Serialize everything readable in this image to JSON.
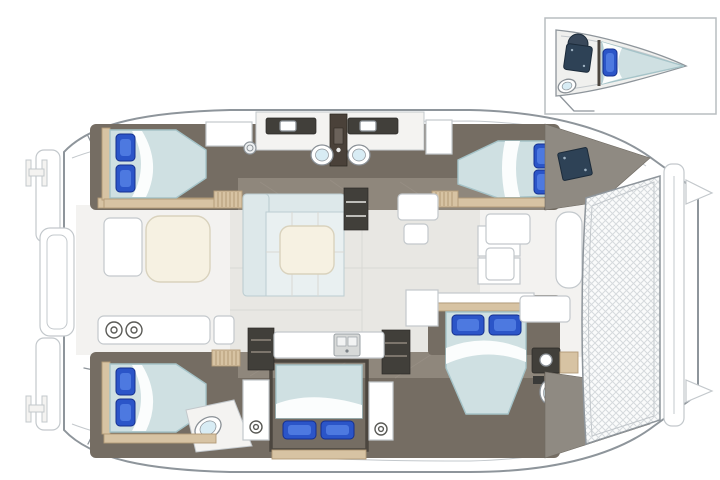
{
  "colors": {
    "hull_outline": "#8e959b",
    "hull_line_light": "#c3c8cc",
    "panel_fill": "#f4f3f1",
    "salon_floor": "#e8e7e3",
    "salon_seam": "#d9d8d4",
    "cockpit_floor": "#f3f2f0",
    "floor_taupe": "#756d63",
    "floor_taupe_light": "#8f877c",
    "floor_seam": "#9a9288",
    "wood": "#d7c3a3",
    "wood_dark": "#b39b77",
    "dark_wood_column": "#4a4139",
    "mattress": "#cfe0e2",
    "mattress_edge": "#a5c3c8",
    "sheet_white": "#fbfdfd",
    "pillow_blue": "#2b55c8",
    "pillow_light": "#4d79e0",
    "pillow_dark": "#16308f",
    "navy_hatch": "#2e4256",
    "charcoal": "#413f3a",
    "toilet_lid": "#d8ecf4",
    "fixture_stroke": "#8a9096",
    "sofa": "#dde8ea",
    "sofa_seat": "#e9f0f1",
    "sofa_line": "#bccdd1",
    "table_cream": "#f6f1e2",
    "table_stroke": "#d9d2bd",
    "tramp_bg": "#fafbfb",
    "tramp_line": "#d6dadd",
    "bow_deck": "#8f8a82",
    "inset_border": "#b9bdc1"
  },
  "diagram": {
    "type": "floorplan",
    "subject": "sailing catamaran deck / accommodation plan",
    "view": "top-down, stern at left, bow (trampoline) at right",
    "hulls": {
      "port_top": {
        "rooms": [
          {
            "name": "aft-cabin",
            "features": [
              "double-bed",
              "2-blue-pillows",
              "wardrobe",
              "companionway-steps",
              "bench-strip"
            ]
          },
          {
            "name": "twin-heads",
            "features": [
              "toilet",
              "toilet",
              "vanity-sink",
              "vanity-sink",
              "shower-column",
              "porthole"
            ]
          },
          {
            "name": "forward-cabin",
            "features": [
              "double-bed",
              "2-blue-pillows",
              "tv-locker",
              "companionway-steps"
            ]
          }
        ]
      },
      "starboard_bottom": {
        "rooms": [
          {
            "name": "aft-cabin",
            "features": [
              "double-bed",
              "2-blue-pillows",
              "toilet",
              "companionway-steps",
              "bench-strip"
            ]
          },
          {
            "name": "mid-cabin",
            "features": [
              "double-bed",
              "2-blue-pillows",
              "side-cabinet",
              "side-cabinet",
              "port-light-knobs"
            ]
          },
          {
            "name": "forward-cabin",
            "features": [
              "double-bed",
              "2-blue-pillows",
              "ensuite-toilet",
              "ensuite-sink",
              "vanity-counter"
            ]
          }
        ]
      }
    },
    "bridgedeck": {
      "rooms": [
        {
          "name": "aft-cockpit",
          "features": [
            "dining-table",
            "bench-seat",
            "aft-bench-with-hatches",
            "side-seat",
            "transom-steps",
            "swim-platform",
            "swim-platform",
            "stern-cleat",
            "stern-cleat",
            "davit-platform"
          ]
        },
        {
          "name": "salon",
          "features": [
            "l-shaped-sofa",
            "coffee-table",
            "shelf-unit",
            "nav-seat",
            "storage-cabinets"
          ]
        },
        {
          "name": "galley",
          "features": [
            "counter",
            "double-sink",
            "cabinet",
            "cabinet"
          ]
        },
        {
          "name": "forward-cockpit",
          "features": [
            "bench-seat",
            "bench-seat",
            "bench-seat",
            "bow-lounge"
          ]
        },
        {
          "name": "foredeck",
          "features": [
            "trampoline",
            "forward-crossbeam",
            "navy-deck-hatch",
            "windlass-fitting",
            "bow-tip",
            "bow-tip"
          ]
        }
      ]
    },
    "inset": {
      "position": "top-right",
      "subject": "bow crew cabin detail",
      "features": [
        "v-berth-bed",
        "blue-pillow",
        "shower-unit",
        "round-hatch",
        "toilet",
        "access-steps"
      ]
    }
  }
}
